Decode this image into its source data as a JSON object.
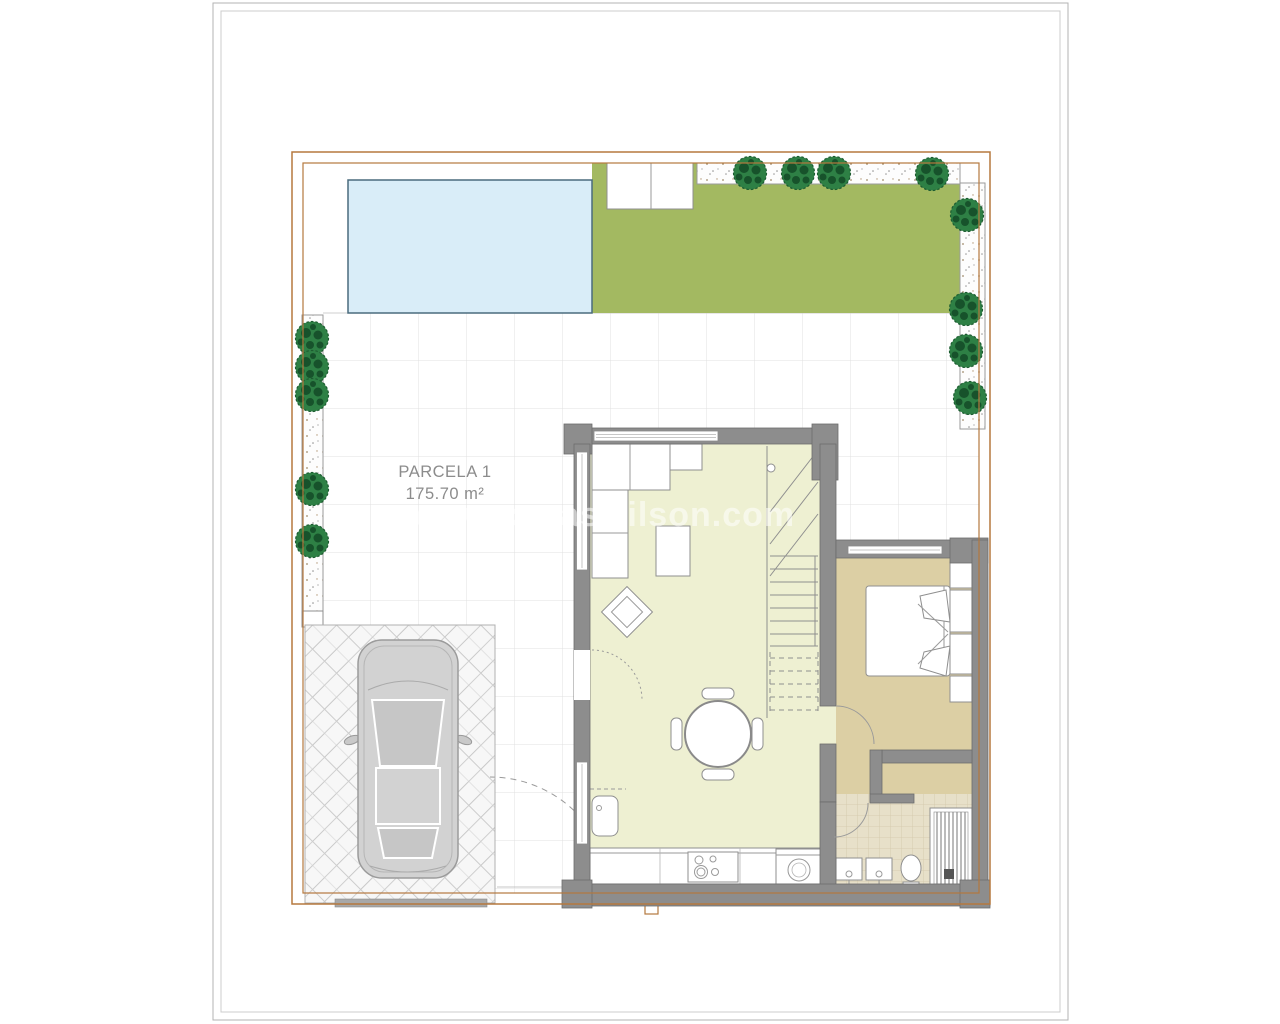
{
  "sheet": {
    "parcel_label": "PARCELA 1",
    "parcel_area": "175.70 m²",
    "watermark": "www.casaswilson.com"
  },
  "colors": {
    "boundary": "#b5783e",
    "pool": "#d9edf8",
    "pool_edge": "#4a6b7d",
    "lawn": "#a3b961",
    "tree": "#2e8045",
    "tree_dark": "#17522b",
    "wall": "#8d8d8d",
    "living_floor": "#eef0d2",
    "bedroom_floor": "#dccfa4",
    "bath_floor": "#e7e0c9",
    "car": "#d2d2d2",
    "fence": "#a8a8a8",
    "tile_line": "#e0e0e0"
  }
}
